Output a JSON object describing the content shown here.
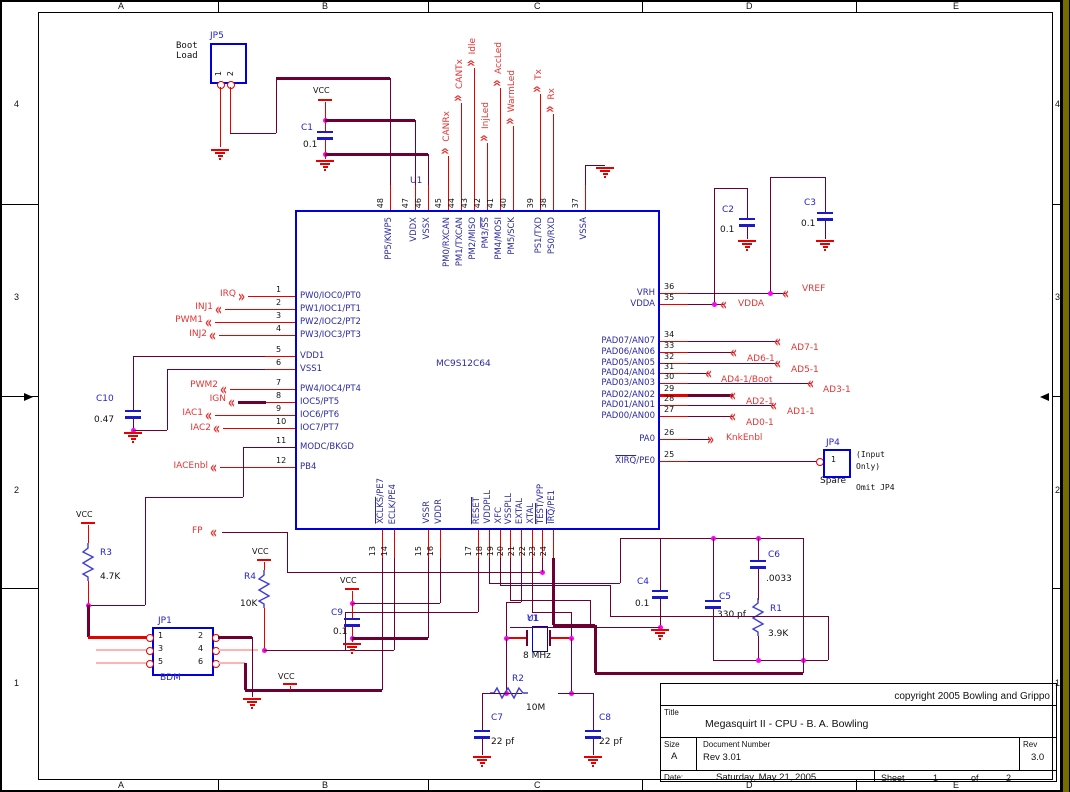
{
  "sheet": {
    "columns": [
      "A",
      "B",
      "C",
      "D",
      "E"
    ],
    "rows": [
      "4",
      "3",
      "2",
      "1"
    ]
  },
  "ic": {
    "ref": "U1",
    "part": "MC9S12C64",
    "left": [
      {
        "num": "1",
        "name": "PW0/IOC0/PT0",
        "net": "IRQ"
      },
      {
        "num": "2",
        "name": "PW1/IOC1/PT1",
        "net": "INJ1"
      },
      {
        "num": "3",
        "name": "PW2/IOC2/PT2",
        "net": "PWM1"
      },
      {
        "num": "4",
        "name": "PW3/IOC3/PT3",
        "net": "INJ2"
      },
      {
        "num": "5",
        "name": "VDD1"
      },
      {
        "num": "6",
        "name": "VSS1"
      },
      {
        "num": "7",
        "name": "PW4/IOC4/PT4",
        "net": "PWM2"
      },
      {
        "num": "8",
        "name": "IOC5/PT5",
        "net": "IGN"
      },
      {
        "num": "9",
        "name": "IOC6/PT6",
        "net": "IAC1"
      },
      {
        "num": "10",
        "name": "IOC7/PT7",
        "net": "IAC2"
      },
      {
        "num": "11",
        "name": "MODC/BKGD"
      },
      {
        "num": "12",
        "name": "PB4",
        "net": "IACEnbl"
      }
    ],
    "right": [
      {
        "num": "36",
        "name": "VRH",
        "net": "VREF"
      },
      {
        "num": "35",
        "name": "VDDA",
        "net": "VDDA"
      },
      {
        "num": "34",
        "name": "PAD07/AN07",
        "net": "AD7-1"
      },
      {
        "num": "33",
        "name": "PAD06/AN06",
        "net": "AD6-1"
      },
      {
        "num": "32",
        "name": "PAD05/AN05",
        "net": "AD5-1"
      },
      {
        "num": "31",
        "name": "PAD04/AN04",
        "net": "AD4-1/Boot"
      },
      {
        "num": "30",
        "name": "PAD03/AN03",
        "net": "AD3-1"
      },
      {
        "num": "29",
        "name": "PAD02/AN02",
        "net": "AD2-1"
      },
      {
        "num": "28",
        "name": "PAD01/AN01",
        "net": "AD1-1"
      },
      {
        "num": "27",
        "name": "PAD00/AN00",
        "net": "AD0-1"
      },
      {
        "num": "26",
        "name": "PA0",
        "net": "KnkEnbl"
      },
      {
        "num": "25",
        "name": "XIRQ/PE0",
        "overline": "XIRQ"
      }
    ],
    "top": [
      {
        "num": "48",
        "name": "PP5/KWP5"
      },
      {
        "num": "47",
        "name": "VDDX"
      },
      {
        "num": "46",
        "name": "VSSX"
      },
      {
        "num": "45",
        "name": "PM0/RXCAN",
        "net": "CANRx"
      },
      {
        "num": "44",
        "name": "PM1/TXCAN",
        "net": "CANTx"
      },
      {
        "num": "43",
        "name": "PM2/MISO",
        "net": "Idle"
      },
      {
        "num": "42",
        "name": "PM3/SS",
        "overline": "SS",
        "net": "InjLed"
      },
      {
        "num": "41",
        "name": "PM4/MOSI",
        "net": "AccLed"
      },
      {
        "num": "40",
        "name": "PM5/SCK",
        "net": "WarmLed"
      },
      {
        "num": "39",
        "name": "PS1/TXD",
        "net": "Tx"
      },
      {
        "num": "38",
        "name": "PS0/RXD",
        "net": "Rx"
      },
      {
        "num": "37",
        "name": "VSSA"
      }
    ],
    "bottom": [
      {
        "num": "13",
        "name": "XCLKS/PE7",
        "overline": "XCLKS"
      },
      {
        "num": "14",
        "name": "ECLK/PE4"
      },
      {
        "num": "15",
        "name": "VSSR"
      },
      {
        "num": "16",
        "name": "VDDR"
      },
      {
        "num": "17",
        "name": "RESET",
        "overline": "RESET"
      },
      {
        "num": "18",
        "name": "VDDPLL"
      },
      {
        "num": "19",
        "name": "XFC"
      },
      {
        "num": "20",
        "name": "VSSPLL"
      },
      {
        "num": "21",
        "name": "EXTAL"
      },
      {
        "num": "22",
        "name": "XTAL"
      },
      {
        "num": "23",
        "name": "TEST/VPP",
        "overline": "TEST"
      },
      {
        "num": "24",
        "name": "IRQ/PE1",
        "overline": "IRQ"
      }
    ]
  },
  "connectors": {
    "jp5": {
      "ref": "JP5",
      "label1": "Boot",
      "label2": "Load",
      "pins": [
        "1",
        "2"
      ]
    },
    "jp1": {
      "ref": "JP1",
      "name": "BDM",
      "left_pins": [
        "1",
        "3",
        "5"
      ],
      "right_pins": [
        "2",
        "4",
        "6"
      ]
    },
    "jp4": {
      "ref": "JP4",
      "pin": "1",
      "name": "Spare",
      "notes": [
        "(Input",
        "Only)",
        "Omit JP4"
      ]
    }
  },
  "components": {
    "C1": "0.1",
    "C2": "0.1",
    "C3": "0.1",
    "C4": "0.1",
    "C5": "330 pf",
    "C6": ".0033",
    "C7": "22 pf",
    "C8": "22 pf",
    "C9": "0.1",
    "C10": "0.47",
    "R1": "3.9K",
    "R2": "10M",
    "R3": "4.7K",
    "R4": "10K",
    "Y1": "8 MHz"
  },
  "nets": {
    "fp": "FP",
    "vcc": "VCC"
  },
  "titleblock": {
    "copyright": "copyright 2005 Bowling and Grippo",
    "title_label": "Title",
    "title": "Megasquirt II - CPU - B. A. Bowling",
    "size_label": "Size",
    "size": "A",
    "docnum_label": "Document Number",
    "docnum": "Rev 3.01",
    "rev_label": "Rev",
    "rev": "3.0",
    "date_label": "Date:",
    "date": "Saturday, May 21, 2005",
    "sheet_label": "Sheet",
    "sheet_num": "1",
    "of_label": "of",
    "sheet_total": "2"
  }
}
